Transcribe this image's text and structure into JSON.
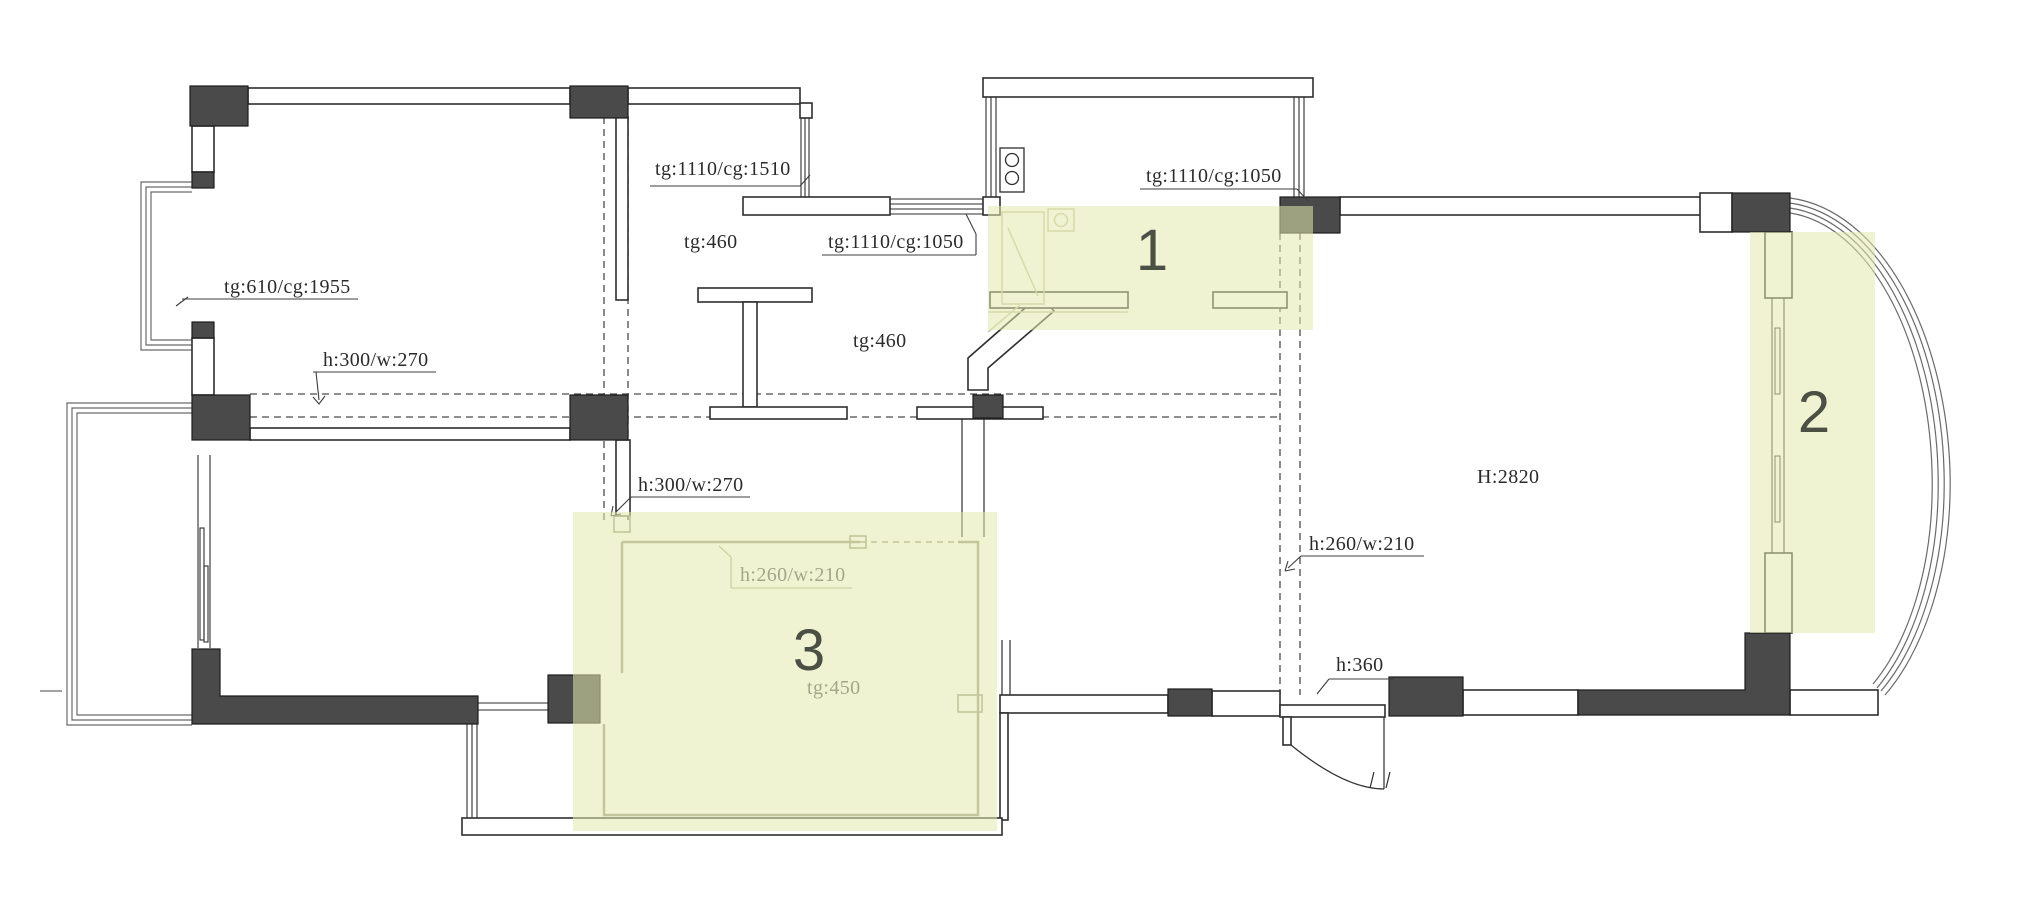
{
  "drawing": {
    "type": "floor-plan",
    "zones": {
      "zone1": "1",
      "zone2": "2",
      "zone3": "3"
    },
    "labels": {
      "bay_window_tl": "tg:610/cg:1955",
      "window_mid_top": "tg:1110/cg:1510",
      "closet_sill": "tg:460",
      "window_hall": "tg:1110/cg:1050",
      "hall_sill": "tg:460",
      "window_top_right": "tg:1110/cg:1050",
      "beam_left": "h:300/w:270",
      "beam_mid": "h:300/w:270",
      "ceiling_height": "H:2820",
      "beam_zone3": "h:260/w:210",
      "beam_living": "h:260/w:210",
      "entry_beam": "h:360",
      "platform_zone3": "tg:450"
    },
    "colors": {
      "highlight": "#e3e9ac",
      "wall_dark": "#4a4a4a",
      "line": "#2e2e2e",
      "new_wall_gray": "#9aa085",
      "label_gray": "#a2a68b"
    }
  }
}
